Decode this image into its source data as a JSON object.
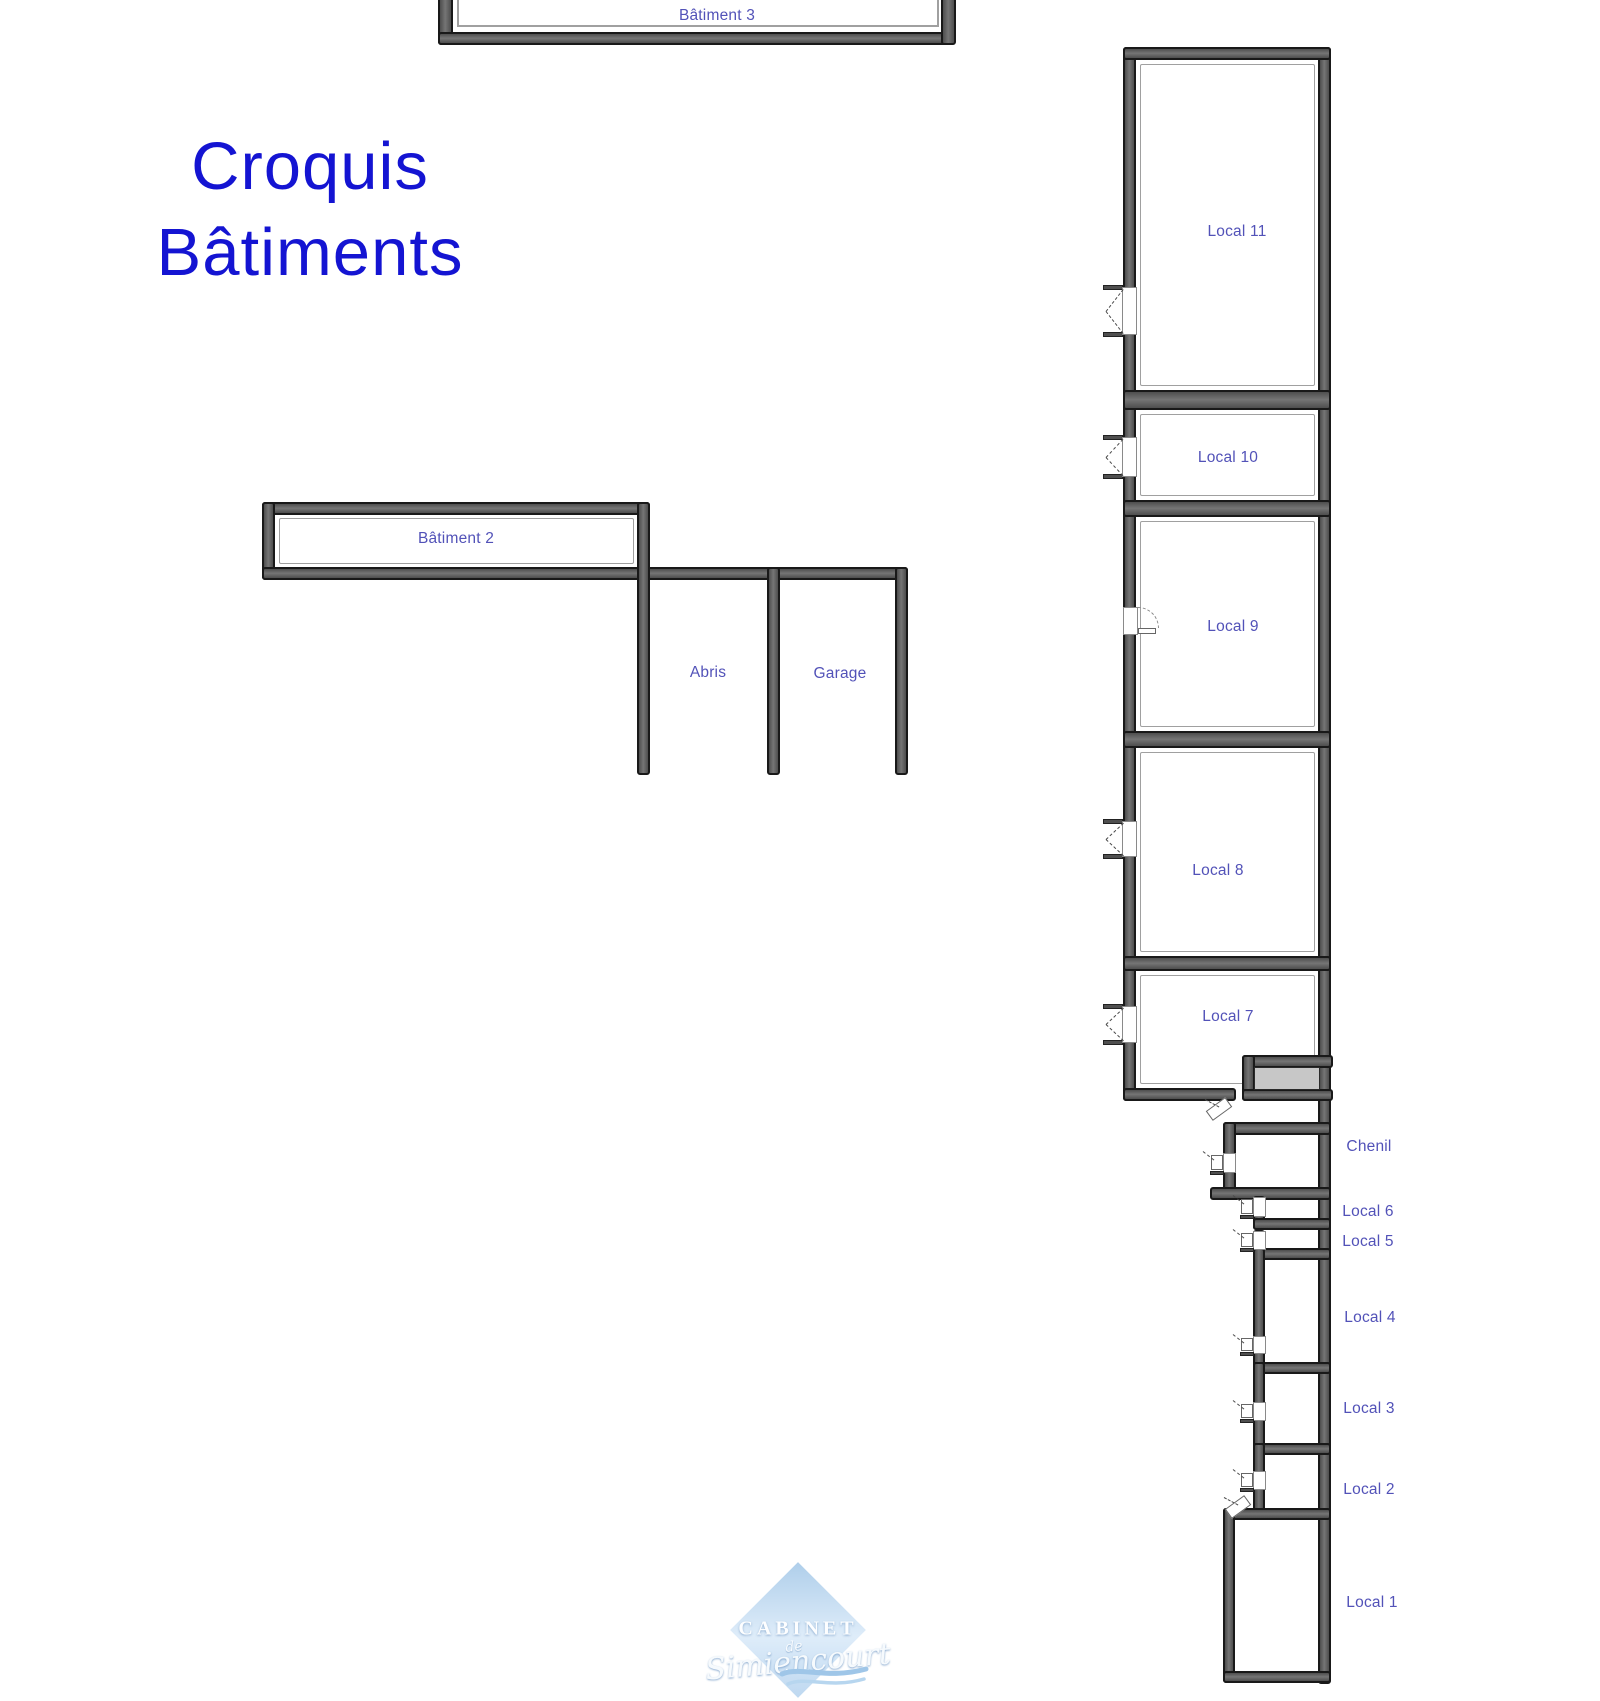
{
  "title": {
    "line1": "Croquis",
    "line2": "Bâtiments"
  },
  "buildings": {
    "batiment3": "Bâtiment 3",
    "batiment2": "Bâtiment 2",
    "abris": "Abris",
    "garage": "Garage"
  },
  "locals": {
    "local11": "Local 11",
    "local10": "Local 10",
    "local9": "Local 9",
    "local8": "Local 8",
    "local7": "Local 7",
    "chenil": "Chenil",
    "local6": "Local 6",
    "local5": "Local 5",
    "local4": "Local 4",
    "local3": "Local 3",
    "local2": "Local 2",
    "local1": "Local 1"
  },
  "watermark": {
    "top": "CABINET",
    "middle": "de",
    "bottom": "Simiencourt"
  },
  "colors": {
    "title_blue": "#1414d2",
    "room_label": "#5252b8",
    "wall_fill": "#5d5d5d",
    "wall_edge": "#191919",
    "annex_fill": "#c7c7c7",
    "watermark_blue": "#a9cbe9"
  }
}
